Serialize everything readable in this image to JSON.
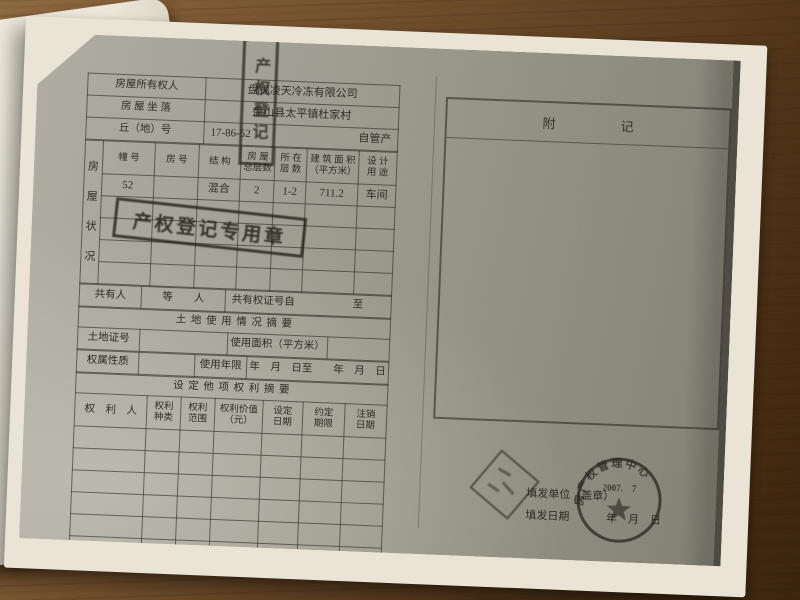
{
  "palette": {
    "desk_wood": "#6b4a29",
    "paper": "#e9e4d6",
    "photocopy_gray": "#9a978a",
    "ink": "#2e2c26"
  },
  "form": {
    "top_rows": [
      {
        "label": "房屋所有权人",
        "value": "盘锦凌天冷冻有限公司"
      },
      {
        "label": "房 屋 坐 落",
        "value": "盘山县太平镇杜家村"
      },
      {
        "label": "丘（地）号",
        "value": "17-86-52",
        "note": "自管产"
      }
    ],
    "status": {
      "side_label": "房\n屋\n状\n况",
      "headers": [
        "幢 号",
        "房 号",
        "结 构",
        "房 屋\n总层数",
        "所 在\n层 数",
        "建 筑 面 积\n（平方米）",
        "设 计\n用 途"
      ],
      "row": [
        "52",
        "",
        "混合",
        "2",
        "1-2",
        "711.2",
        "车间"
      ]
    },
    "coowner": {
      "label": "共有人",
      "middle": "等　　人",
      "cert_from": "共有权证号自",
      "cert_to": "至"
    },
    "land": {
      "title": "土 地 使 用 情 况 摘 要",
      "cert_label": "土地证号",
      "area_label": "使用面积（平方米）",
      "nature_label": "权属性质",
      "term_label": "使用年限",
      "term_value": "年　月　日至　　年　月　日"
    },
    "rights": {
      "title": "设 定 他 项 权 利 摘 要",
      "headers": [
        "权　利　人",
        "权利\n种类",
        "权利\n范围",
        "权利价值\n（元）",
        "设定\n日期",
        "约定\n期限",
        "注销\n日期"
      ]
    },
    "appendix_title": "附　　　　　记",
    "issue": {
      "unit_label": "填发单位（盖章）",
      "date_label": "填发日期",
      "date_blank": "年　月　日"
    }
  },
  "stamps": {
    "registry": {
      "text": "产权登记专用章"
    },
    "vertical": {
      "glyphs": "产权登记",
      "legible": false
    },
    "round_seal": {
      "arc_text": "房产权管理中心",
      "date": "2007.　7"
    },
    "diamond": {
      "type": "name-seal",
      "legible": false
    }
  }
}
